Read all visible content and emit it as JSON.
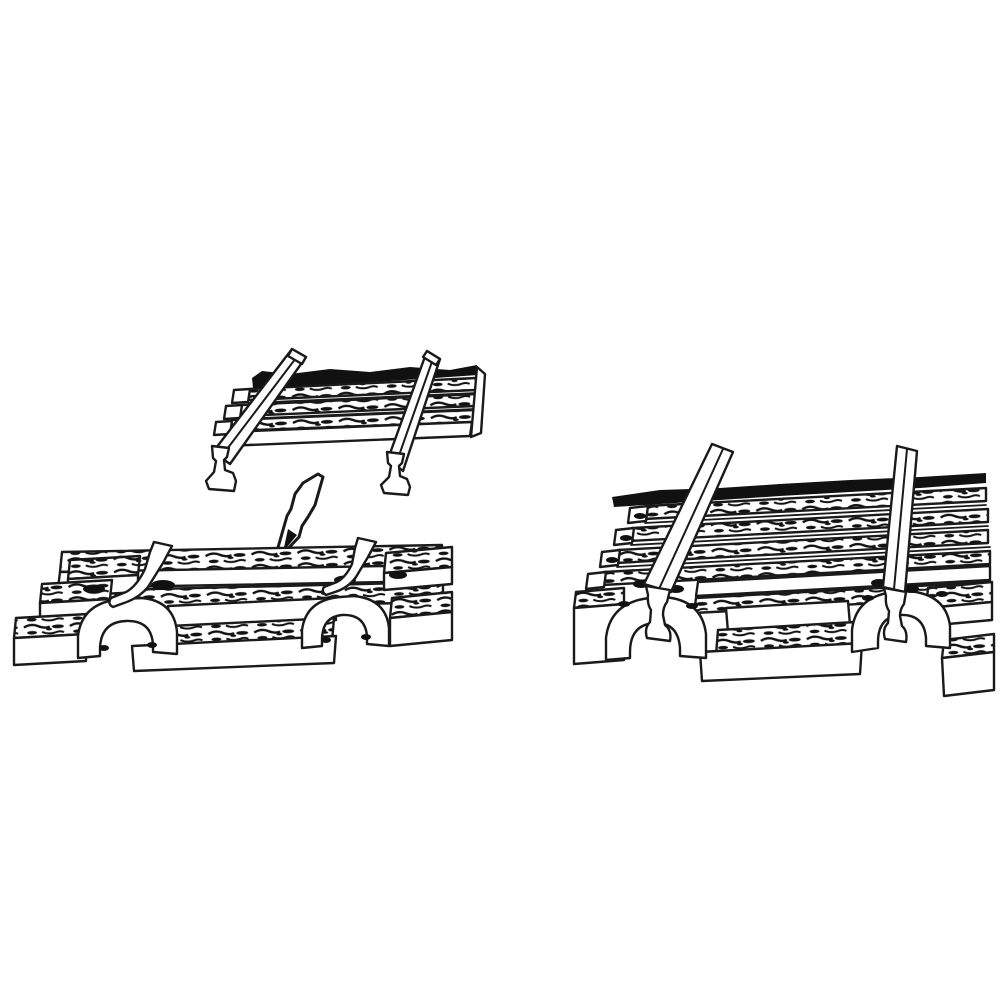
{
  "illustration": {
    "description": "Black-and-white line drawing of model railroad track assembly: two loose rails above a molded tie strip, a bent arrow indicating insertion, a sleeper base with arched rail chairs and clip posts, and a fully assembled track section on the right.",
    "parts": {
      "exploded_rails": "Loose rails over tie strip",
      "arrow": "Insertion direction arrow",
      "sleeper_base": "Sleeper base with rail chairs and clips",
      "assembled_track": "Assembled track section with rails seated"
    }
  },
  "colors": {
    "background": "#ffffff",
    "line": "#1a1a1a",
    "texture": "#111111",
    "fill": "#ffffff"
  }
}
